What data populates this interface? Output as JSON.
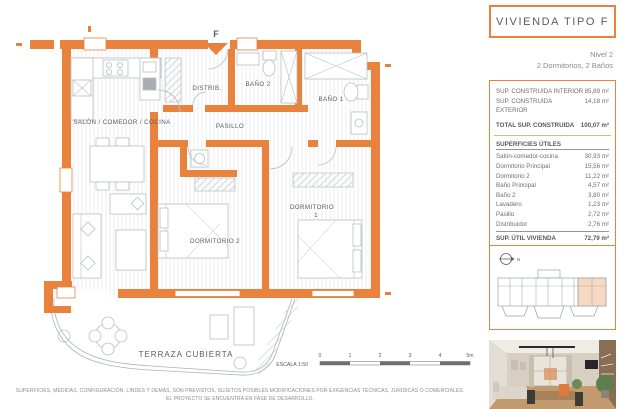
{
  "header": {
    "title": "VIVIENDA TIPO F",
    "level": "Nivel 2",
    "subtitle": "2 Dormitorios, 2 Baños"
  },
  "areas": {
    "construida": [
      {
        "label": "SUP. CONSTRUIDA INTERIOR",
        "value": "85,89 m²"
      },
      {
        "label": "SUP. CONSTRUIDA EXTERIOR",
        "value": "14,18 m²"
      }
    ],
    "total": {
      "label": "TOTAL SUP. CONSTRUIDA",
      "value": "100,07 m²"
    },
    "utiles_header": "SUPERFICIES ÚTILES",
    "utiles": [
      {
        "label": "Salón-comedor-cocina",
        "value": "30,93 m²"
      },
      {
        "label": "Dormitorio Principal",
        "value": "15,56 m²"
      },
      {
        "label": "Dormitorio 2",
        "value": "11,22 m²"
      },
      {
        "label": "Baño Principal",
        "value": "4,57 m²"
      },
      {
        "label": "Baño 2",
        "value": "3,80 m²"
      },
      {
        "label": "Lavadero",
        "value": "1,23 m²"
      },
      {
        "label": "Pasillo",
        "value": "2,72 m²"
      },
      {
        "label": "Distribuidor",
        "value": "2,76 m²"
      }
    ],
    "util_vivienda": {
      "label": "SUP. ÚTIL VIVIENDA",
      "value": "72,79 m²"
    },
    "util_terraza": {
      "label": "SUP. ÚTIL TERRAZA",
      "value": "11,79 m²"
    }
  },
  "plan": {
    "entrance": "F",
    "salon": "SALÓN / COMEDOR / COCINA",
    "distrib": "DISTRIB.",
    "bano2": "BAÑO 2",
    "bano1": "BAÑO 1",
    "pasillo": "PASILLO",
    "dorm2": "DORMITORIO 2",
    "dorm1_l1": "DORMITORIO",
    "dorm1_l2": "1",
    "terraza": "TERRAZA CUBIERTA"
  },
  "scale": {
    "label": "ESCALA 1:50",
    "ticks": [
      "0",
      "1",
      "2",
      "3",
      "4",
      "5m"
    ]
  },
  "keyplan": {
    "north": "N"
  },
  "footer": {
    "line1": "SUPERFICIES, MEDIDAS, CONFIGURACIÓN, LINDES Y DEMÁS, SON PREVISTOS, SUJETOS POSIBLES MODIFICACIONES POR EXIGENCIAS TÉCNICAS, JURÍDICAS O COMERCIALES.",
    "line2": "EL PROYECTO SE ENCUENTRA EN FASE DE DESARROLLO."
  },
  "colors": {
    "accent": "#e8823c",
    "highlight": "#f6d9c2",
    "text": "#58595b"
  }
}
